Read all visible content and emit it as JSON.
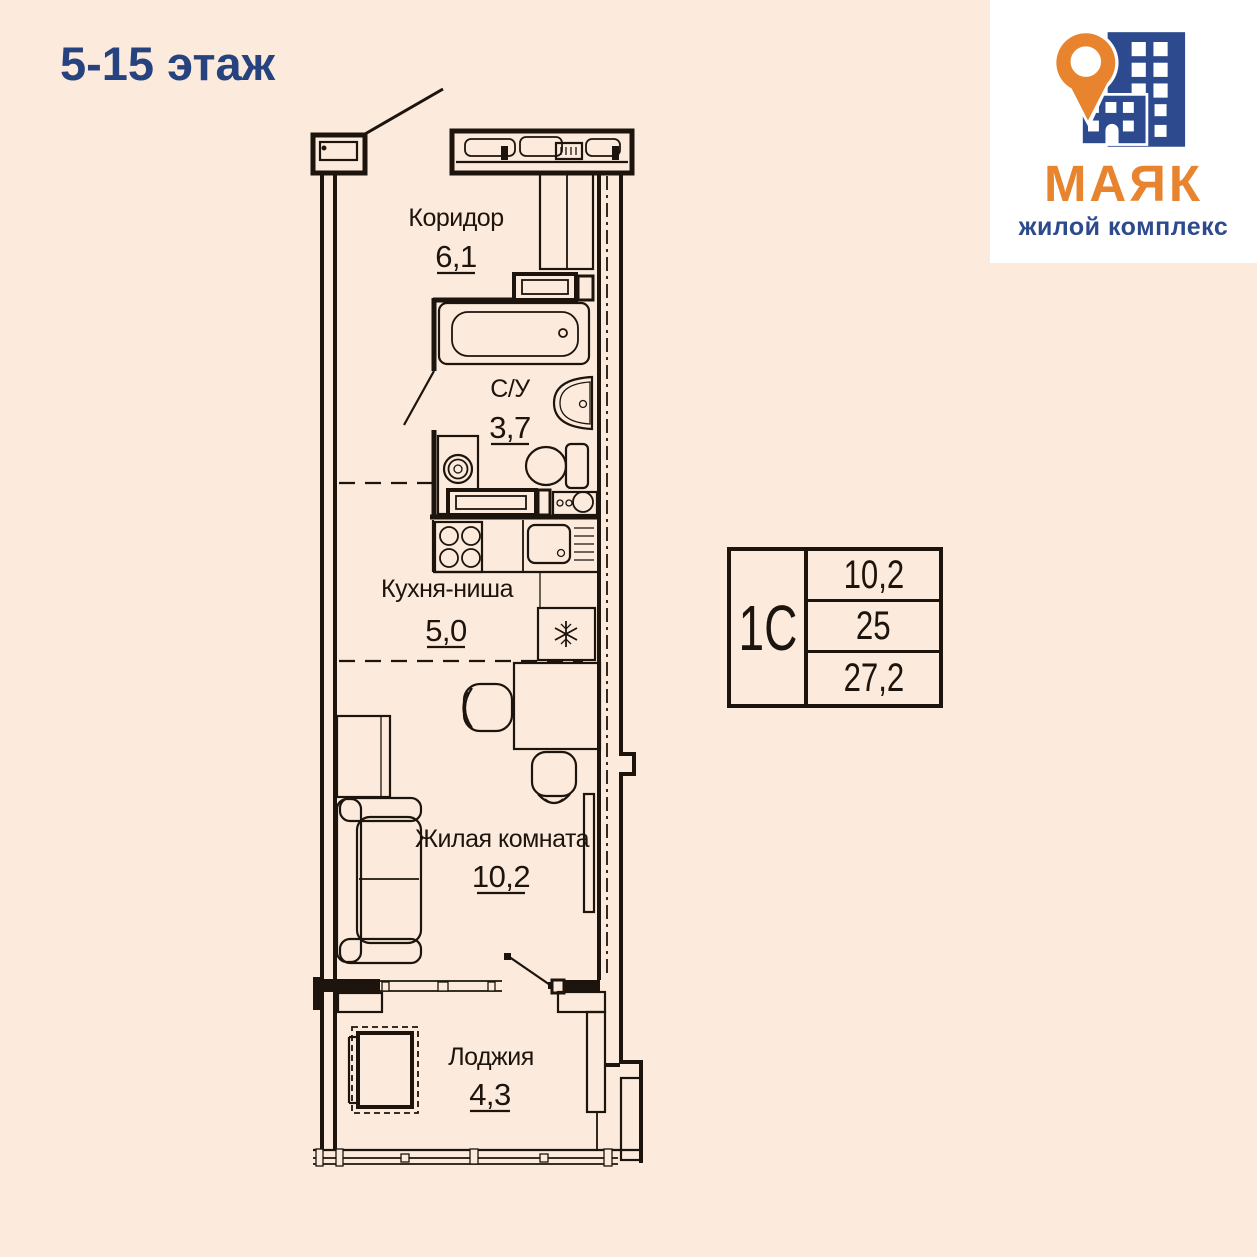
{
  "page": {
    "floor_label": "5-15 этаж"
  },
  "logo": {
    "title": "МАЯК",
    "subtitle": "жилой комплекс"
  },
  "rooms": {
    "corridor": {
      "name": "Коридор",
      "area": "6,1"
    },
    "bathroom": {
      "name": "С/У",
      "area": "3,7"
    },
    "kitchen": {
      "name": "Кухня-ниша",
      "area": "5,0"
    },
    "living": {
      "name": "Жилая комната",
      "area": "10,2"
    },
    "loggia": {
      "name": "Лоджия",
      "area": "4,3"
    }
  },
  "stamp": {
    "unit_type": "1С",
    "rows": [
      "10,2",
      "25",
      "27,2"
    ]
  },
  "colors": {
    "bg": "#fcebdd",
    "line": "#1c140d",
    "title": "#27437f",
    "orange": "#e8832e",
    "logoblue": "#2c4a8d",
    "white": "#ffffff"
  }
}
